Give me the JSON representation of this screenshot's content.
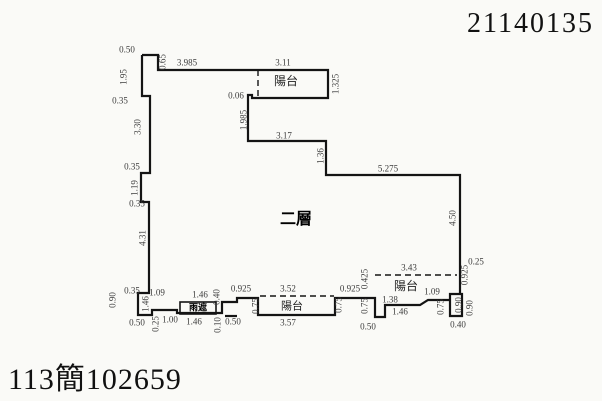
{
  "header": {
    "doc_number": "21140135"
  },
  "footer": {
    "case_number": "113簡102659"
  },
  "colors": {
    "paper": "#fafaf7",
    "ink": "#141414",
    "dim_text": "#3c3c3c"
  },
  "plan": {
    "floor_label": "二層",
    "solid_paths": [
      "M142,55 H158 V70 H328 V98 H252 V95 H248 V141 H326 V175 H460 V294 H450 V316 H462 V294 H459",
      "M142,55 V96 H150 V173 H141 V202 H149 V293 H138 V315 H152 V310 H177 V313 H222 V302 H237 V298 H258 V315 H335 V298 H375 V317 H385 V305 H420 L428,300 H450",
      "M225,316 H237"
    ],
    "dashed_paths": [
      "M258,70 V98",
      "M260,296 H334",
      "M375,275 H457"
    ],
    "canopy_block": {
      "x": 180,
      "y": 302,
      "w": 36,
      "h": 12,
      "label": "雨遮"
    },
    "text_labels": [
      {
        "t": "陽台",
        "x": 286,
        "y": 81,
        "size": 12,
        "cls": ""
      },
      {
        "t": "陽台",
        "x": 292,
        "y": 307,
        "size": 11,
        "cls": ""
      },
      {
        "t": "陽台",
        "x": 406,
        "y": 286,
        "size": 12,
        "cls": ""
      },
      {
        "t": "二層",
        "x": 296,
        "y": 220,
        "size": 16,
        "cls": "floor"
      }
    ],
    "dim_labels_h": [
      {
        "t": "0.50",
        "x": 127,
        "y": 50
      },
      {
        "t": "3.985",
        "x": 187,
        "y": 63
      },
      {
        "t": "3.11",
        "x": 283,
        "y": 63
      },
      {
        "t": "0.06",
        "x": 236,
        "y": 96
      },
      {
        "t": "0.35",
        "x": 120,
        "y": 101
      },
      {
        "t": "3.17",
        "x": 284,
        "y": 136
      },
      {
        "t": "5.275",
        "x": 388,
        "y": 169
      },
      {
        "t": "0.35",
        "x": 132,
        "y": 167
      },
      {
        "t": "0.35",
        "x": 137,
        "y": 204
      },
      {
        "t": "0.35",
        "x": 132,
        "y": 291
      },
      {
        "t": "1.09",
        "x": 157,
        "y": 293
      },
      {
        "t": "0.50",
        "x": 137,
        "y": 323
      },
      {
        "t": "1.00",
        "x": 170,
        "y": 320
      },
      {
        "t": "1.46",
        "x": 200,
        "y": 295
      },
      {
        "t": "1.46",
        "x": 194,
        "y": 322
      },
      {
        "t": "0.925",
        "x": 241,
        "y": 289
      },
      {
        "t": "3.52",
        "x": 288,
        "y": 289
      },
      {
        "t": "0.925",
        "x": 350,
        "y": 289
      },
      {
        "t": "3.57",
        "x": 288,
        "y": 323
      },
      {
        "t": "0.50",
        "x": 233,
        "y": 322
      },
      {
        "t": "3.43",
        "x": 409,
        "y": 268
      },
      {
        "t": "0.50",
        "x": 368,
        "y": 327
      },
      {
        "t": "1.38",
        "x": 390,
        "y": 300
      },
      {
        "t": "1.46",
        "x": 400,
        "y": 312
      },
      {
        "t": "1.09",
        "x": 432,
        "y": 292
      },
      {
        "t": "0.40",
        "x": 458,
        "y": 325
      },
      {
        "t": "0.25",
        "x": 476,
        "y": 262
      }
    ],
    "dim_labels_v": [
      {
        "t": "1.95",
        "x": 124,
        "y": 77
      },
      {
        "t": "0.65",
        "x": 163,
        "y": 62
      },
      {
        "t": "3.30",
        "x": 138,
        "y": 127
      },
      {
        "t": "1.19",
        "x": 135,
        "y": 188
      },
      {
        "t": "4.31",
        "x": 143,
        "y": 238
      },
      {
        "t": "1.325",
        "x": 336,
        "y": 84
      },
      {
        "t": "1.985",
        "x": 244,
        "y": 120
      },
      {
        "t": "1.36",
        "x": 321,
        "y": 156
      },
      {
        "t": "4.50",
        "x": 453,
        "y": 218
      },
      {
        "t": "0.90",
        "x": 113,
        "y": 300
      },
      {
        "t": "0.25",
        "x": 156,
        "y": 324
      },
      {
        "t": "1.46",
        "x": 146,
        "y": 304
      },
      {
        "t": "0.40",
        "x": 217,
        "y": 297
      },
      {
        "t": "0.10",
        "x": 218,
        "y": 325
      },
      {
        "t": "0.75",
        "x": 256,
        "y": 306
      },
      {
        "t": "0.75",
        "x": 339,
        "y": 305
      },
      {
        "t": "0.425",
        "x": 365,
        "y": 279
      },
      {
        "t": "0.75",
        "x": 365,
        "y": 306
      },
      {
        "t": "0.925",
        "x": 465,
        "y": 275
      },
      {
        "t": "0.75",
        "x": 441,
        "y": 307
      },
      {
        "t": "0.90",
        "x": 459,
        "y": 305
      },
      {
        "t": "0.90",
        "x": 470,
        "y": 308
      }
    ]
  }
}
